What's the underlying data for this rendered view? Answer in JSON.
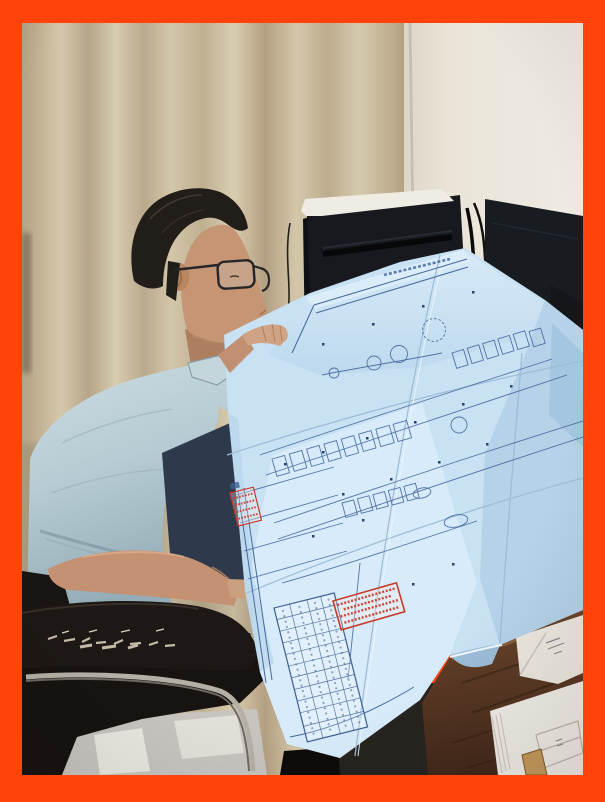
{
  "meta": {
    "type": "photograph",
    "description": "A man with glasses, dark short hair and a light grey-blue polo shirt sits in a worn black office chair at a dark wooden desk, leaning over a large unfolded light-blue architectural blueprint. The floor-plan sheet bears red approval stamps and a title-block table. Behind him are a beige curtain, a pale wall, a black computer tower with a sheet of paper on top, and dark monitors. The photo has a bright orange-red border frame."
  },
  "palette": {
    "border": "#ff430a",
    "curtain": "#c8ba9c",
    "wall": "#eae4d8",
    "tower": "#17191f",
    "monitor": "#181b20",
    "shirt": "#b6cbd3",
    "skin": "#c69574",
    "hair": "#211d19",
    "chair": "#171310",
    "desk": "#5e3c26",
    "paper": "#efece4",
    "floor": "#c7c4bf",
    "trousers": "#2e3a4c",
    "blueprint": "#c8e1f3",
    "blueprint_line": "#44679c",
    "stamp_red": "#c8382a",
    "chrome": "#b5b0a6"
  }
}
